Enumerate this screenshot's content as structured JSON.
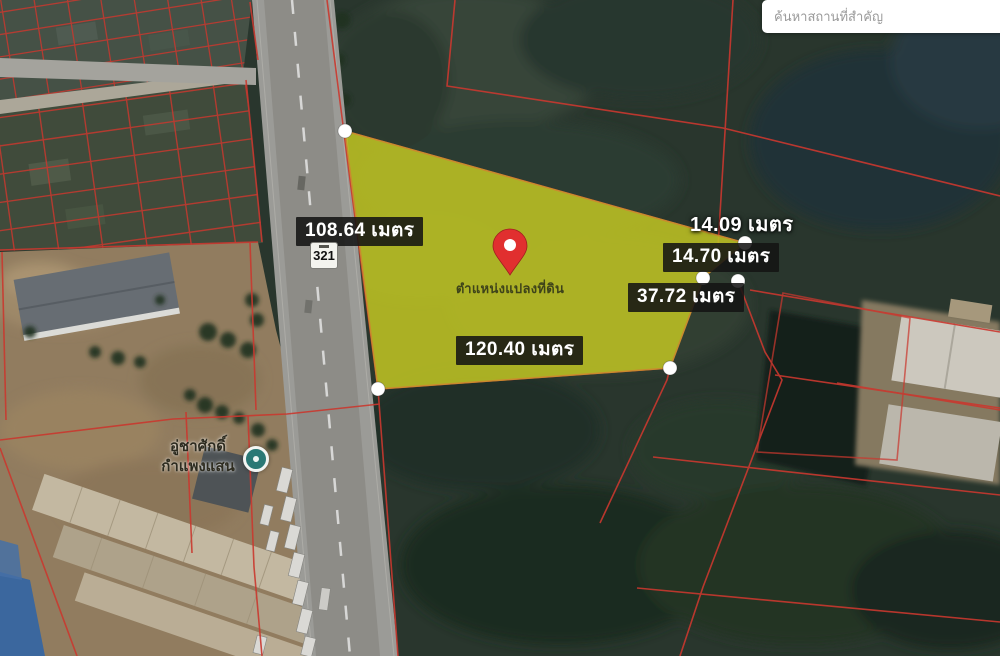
{
  "search_box": {
    "placeholder": "ค้นหาสถานที่สำคัญ"
  },
  "highway_shield": {
    "number": "321"
  },
  "parcel": {
    "marker_label": "ตำแหน่งแปลงที่ดิน",
    "fill_color": "#bdc223",
    "boundary_color": "#d63c32",
    "vertex_dot_color": "#ffffff",
    "measurements": {
      "west": "108.64 เมตร",
      "northeast": "14.09 เมตร",
      "east_upper": "14.70 เมตร",
      "east_lower": "37.72 เมตร",
      "south": "120.40 เมตร"
    }
  },
  "poi": {
    "name_line1": "อู่ชาศักดิ์",
    "name_line2": "กำแพงแสน"
  },
  "colors": {
    "pin": "#e12f2f",
    "measurement_label_bg": "#141414",
    "measurement_label_text": "#ffffff",
    "road": "#a5a4a0",
    "dirt": "#9a8465",
    "vegetation": "#2c3a30"
  }
}
